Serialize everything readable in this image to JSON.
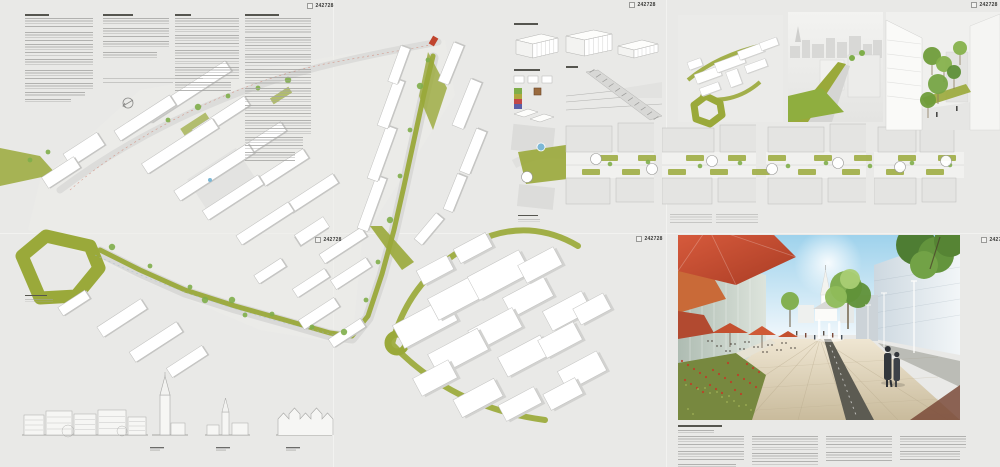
{
  "board_id": "242728",
  "boards": [
    {
      "position": "top-left",
      "id": "242728"
    },
    {
      "position": "top-middle",
      "id": "242728"
    },
    {
      "position": "top-right",
      "id": "242728"
    },
    {
      "position": "bottom-left",
      "id": "242728"
    },
    {
      "position": "bottom-middle",
      "id": "242728"
    },
    {
      "position": "bottom-right",
      "id": "242728"
    }
  ],
  "palette": {
    "background": "#e9e9e7",
    "corridor-green": "#9aa93a",
    "tree-green": "#7fae4a",
    "accent-red": "#c0442e",
    "umbrella-red": "#c9553c",
    "sky-blue": "#9ed2ec",
    "water-blue": "#7db8d6",
    "paving-beige": "#d9ceb4",
    "line-gray": "#b9b9b7",
    "building-white": "#ffffff"
  }
}
